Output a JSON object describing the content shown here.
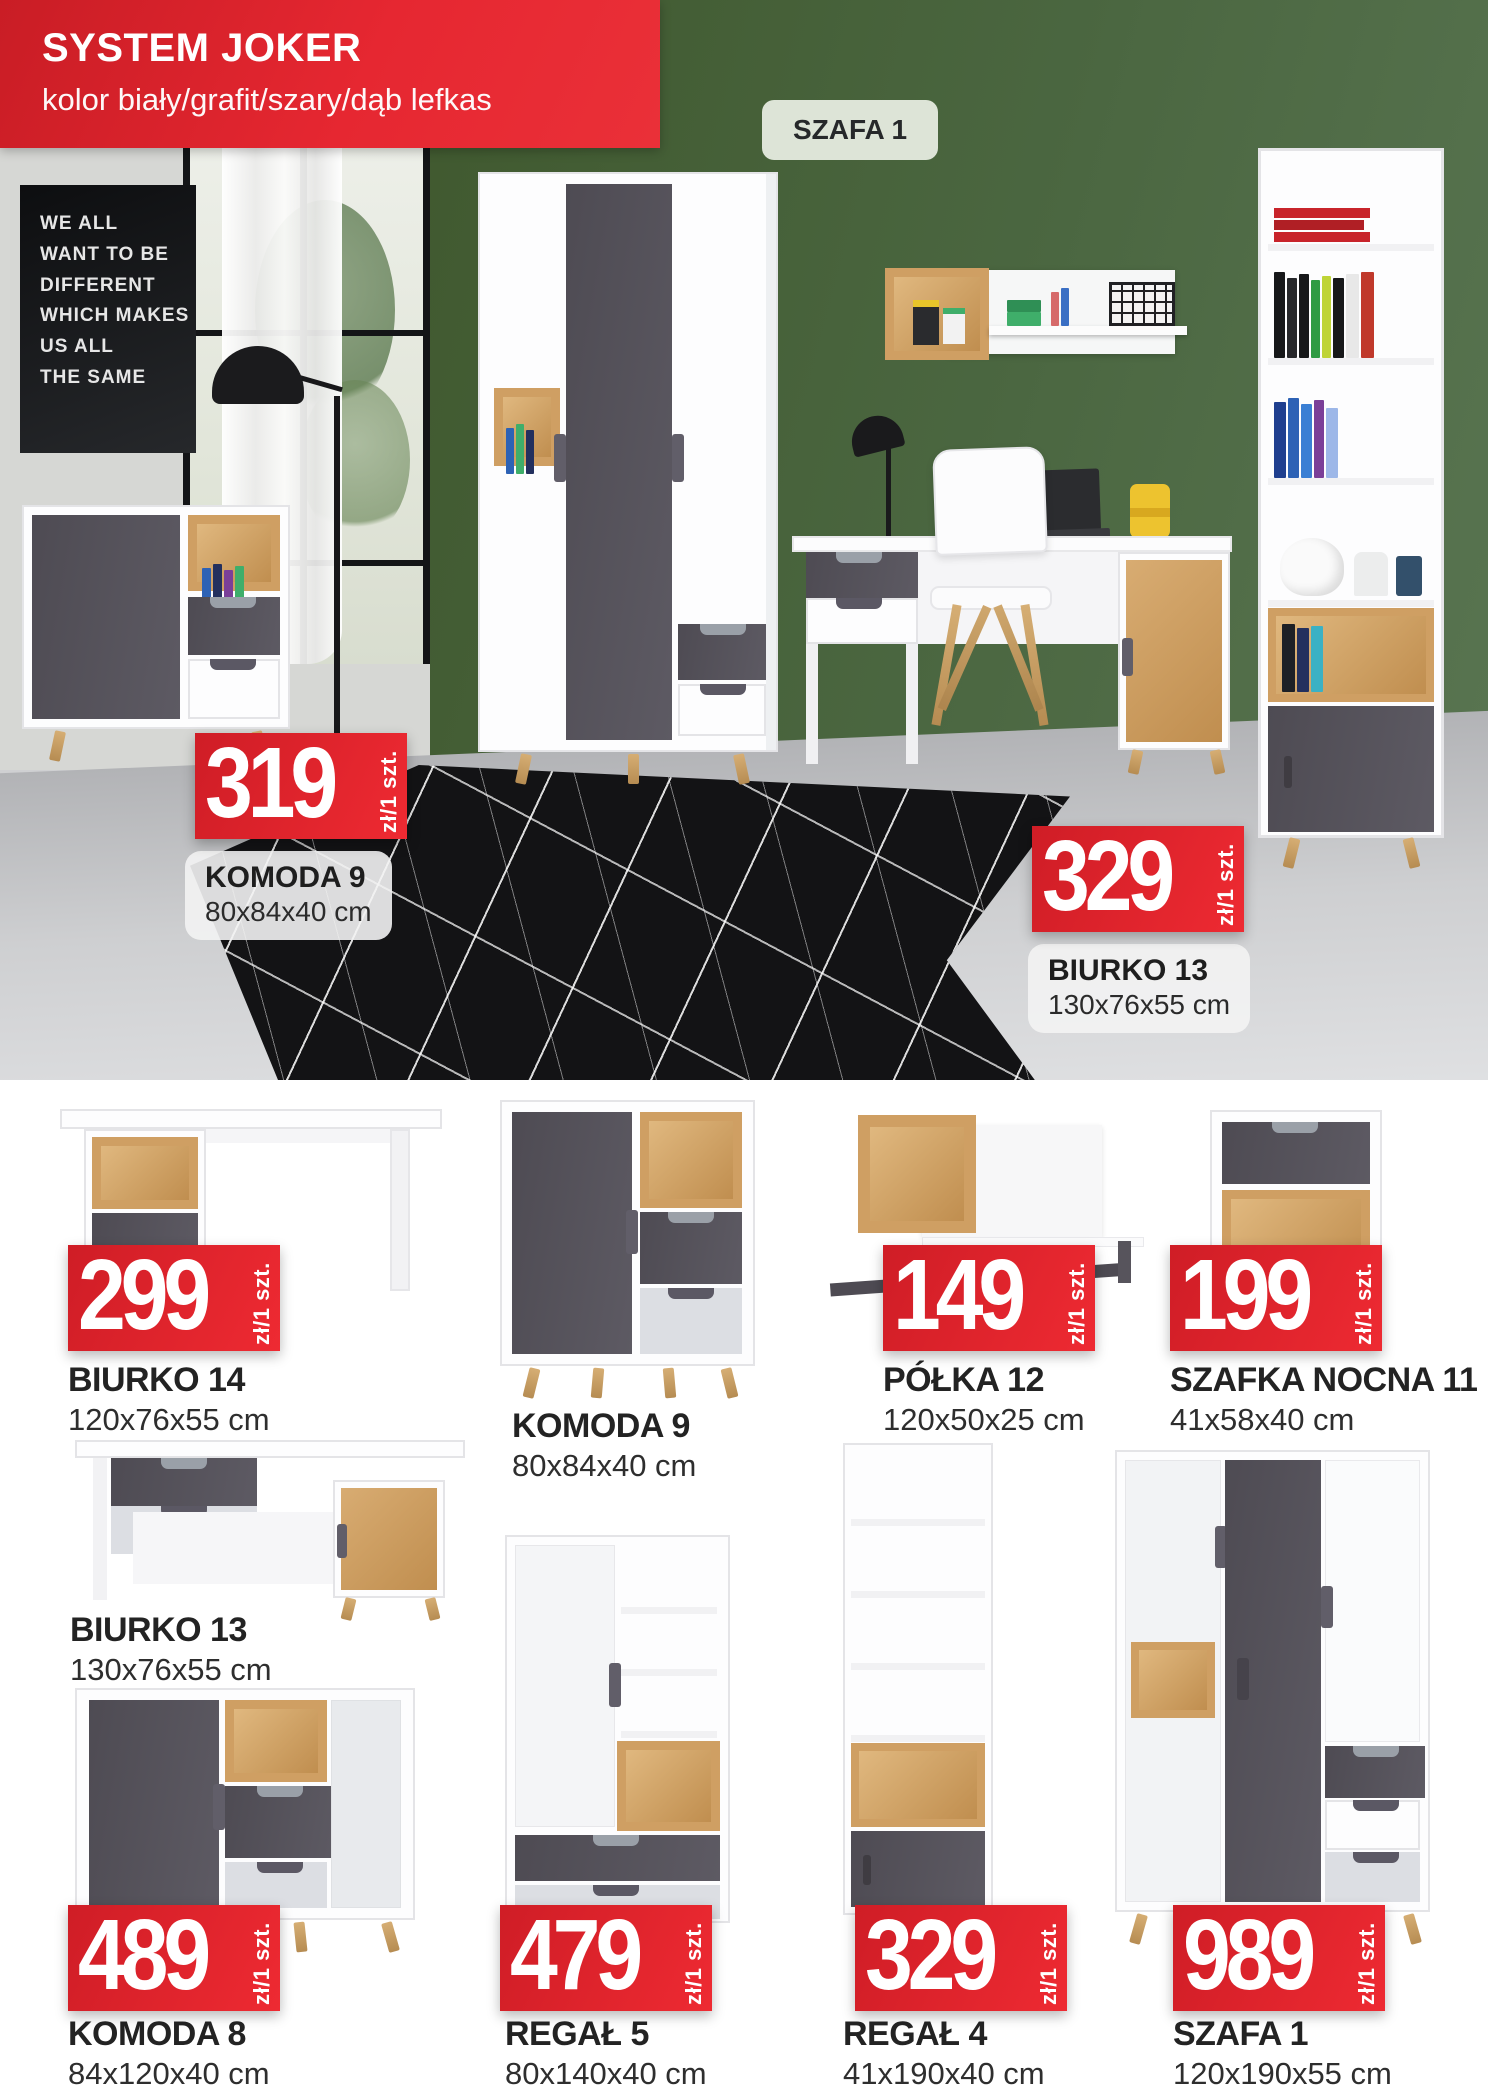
{
  "banner": {
    "title": "SYSTEM JOKER",
    "subtitle": "kolor biały/grafit/szary/dąb lefkas"
  },
  "hero": {
    "tag": "SZAFA 1",
    "poster_lines": [
      "WE ALL",
      "WANT TO BE",
      "DIFFERENT",
      "WHICH MAKES",
      "US ALL",
      "THE SAME"
    ],
    "callouts": [
      {
        "price": "319",
        "unit": "zł/1 szt.",
        "name": "KOMODA 9",
        "dims": "80x84x40 cm"
      },
      {
        "price": "329",
        "unit": "zł/1 szt.",
        "name": "BIURKO 13",
        "dims": "130x76x55 cm"
      }
    ]
  },
  "products": [
    {
      "name": "BIURKO 14",
      "dims": "120x76x55 cm",
      "price": "299",
      "unit": "zł/1 szt."
    },
    {
      "name": "KOMODA 9",
      "dims": "80x84x40 cm"
    },
    {
      "name": "PÓŁKA 12",
      "dims": "120x50x25 cm",
      "price": "149",
      "unit": "zł/1 szt."
    },
    {
      "name": "SZAFKA NOCNA 11",
      "dims": "41x58x40 cm",
      "price": "199",
      "unit": "zł/1 szt."
    },
    {
      "name": "BIURKO 13",
      "dims": "130x76x55 cm"
    },
    {
      "name": "KOMODA 8",
      "dims": "84x120x40 cm",
      "price": "489",
      "unit": "zł/1 szt."
    },
    {
      "name": "REGAŁ 5",
      "dims": "80x140x40 cm",
      "price": "479",
      "unit": "zł/1 szt."
    },
    {
      "name": "REGAŁ 4",
      "dims": "41x190x40 cm",
      "price": "329",
      "unit": "zł/1 szt."
    },
    {
      "name": "SZAFA 1",
      "dims": "120x190x55 cm",
      "price": "989",
      "unit": "zł/1 szt."
    }
  ],
  "colors": {
    "accent_red": "#e2232b",
    "wall_green": "#4b6741",
    "graphite": "#56535b",
    "oak": "#cf9f63",
    "light_gray": "#dcdee3",
    "wood_legs": "#c9a066"
  }
}
